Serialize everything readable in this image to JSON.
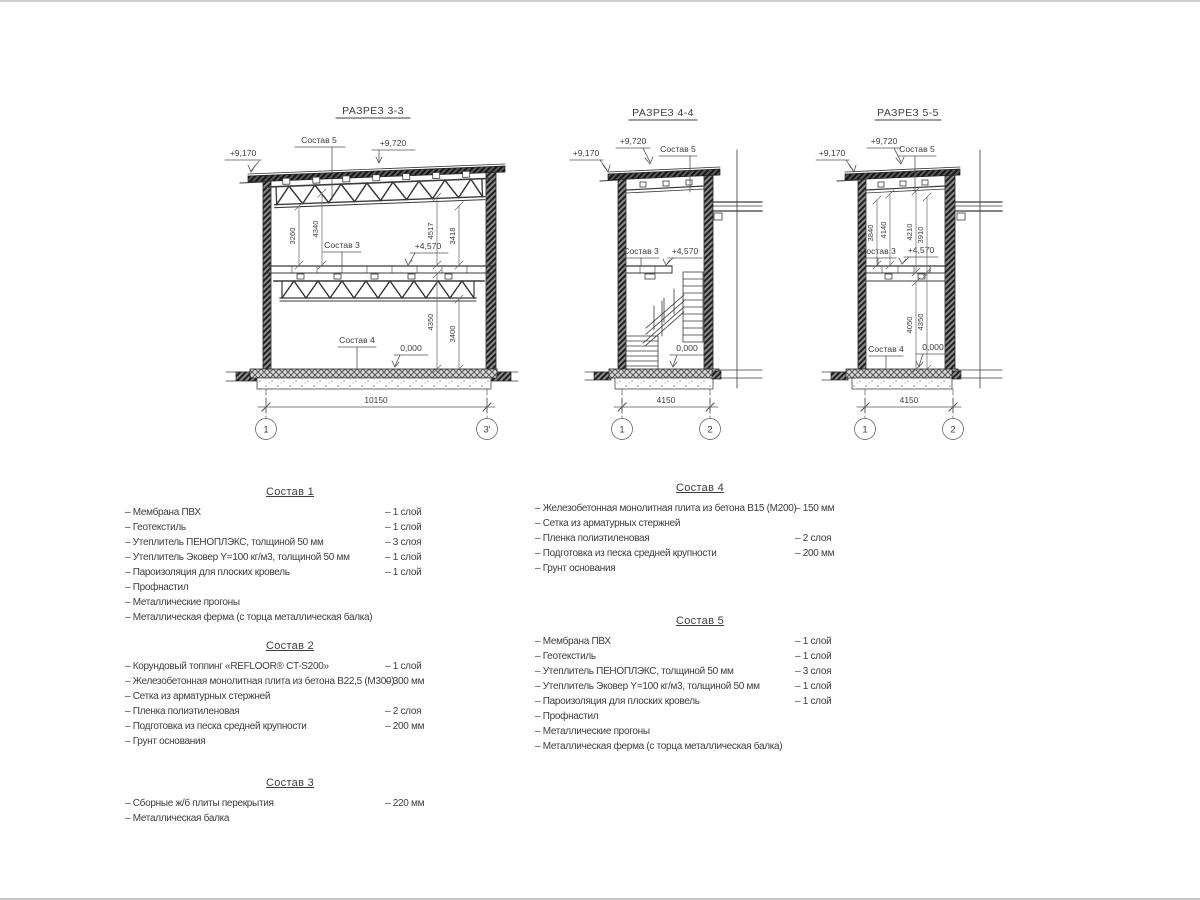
{
  "colors": {
    "line": "#3a3a3a",
    "wall_fill": "#4a4a4a",
    "dim_line": "#666666",
    "background": "#ffffff"
  },
  "sections": [
    {
      "title": "РАЗРЕЗ 3-3",
      "elev_eave": "+9,170",
      "elev_top": "+9,720",
      "elev_mid": "+4,570",
      "elev_zero": "0,000",
      "label_comp5": "Состав 5",
      "label_comp3": "Состав 3",
      "label_comp4": "Состав 4",
      "dim_u1": "3260",
      "dim_u2": "4340",
      "dim_u3": "4517",
      "dim_u4": "3418",
      "dim_l1": "4350",
      "dim_l2": "3400",
      "dim_width": "10150",
      "axis_left": "1",
      "axis_right": "3'"
    },
    {
      "title": "РАЗРЕЗ 4-4",
      "elev_eave": "+9,170",
      "elev_top": "+9,720",
      "elev_mid": "+4,570",
      "elev_zero": "0,000",
      "label_comp5": "Состав 5",
      "label_comp3": "Состав 3",
      "dim_width": "4150",
      "axis_left": "1",
      "axis_right": "2"
    },
    {
      "title": "РАЗРЕЗ 5-5",
      "elev_eave": "+9,170",
      "elev_top": "+9,720",
      "elev_mid": "+4,570",
      "elev_zero": "0,000",
      "label_comp5": "Состав 5",
      "label_comp3": "Состав 3",
      "label_comp4": "Состав 4",
      "dim_u1": "3840",
      "dim_u2": "4140",
      "dim_u3": "4210",
      "dim_u4": "3910",
      "dim_l1": "4050",
      "dim_l2": "4350",
      "dim_width": "4150",
      "axis_left": "1",
      "axis_right": "2"
    }
  ],
  "compositions": [
    {
      "title": "Состав 1",
      "items": [
        {
          "name": "– Мембрана ПВХ",
          "value": "– 1 слой"
        },
        {
          "name": "– Геотекстиль",
          "value": "– 1 слой"
        },
        {
          "name": "– Утеплитель ПЕНОПЛЭКС, толщиной 50 мм",
          "value": "– 3 слоя"
        },
        {
          "name": "– Утеплитель Эковер Y=100 кг/м3, толщиной 50 мм",
          "value": "– 1 слой"
        },
        {
          "name": "– Пароизоляция для плоских кровель",
          "value": "– 1 слой"
        },
        {
          "name": "– Профнастил",
          "value": ""
        },
        {
          "name": "– Металлические прогоны",
          "value": ""
        },
        {
          "name": "– Металлическая ферма (с торца металлическая балка)",
          "value": ""
        }
      ]
    },
    {
      "title": "Состав 2",
      "items": [
        {
          "name": "– Корундовый топпинг «REFLOOR® CT-S200»",
          "value": "– 1 слой"
        },
        {
          "name": "– Железобетонная  монолитная плита из бетона В22,5 (М300)",
          "value": "– 300 мм"
        },
        {
          "name": "– Сетка из арматурных стержней",
          "value": ""
        },
        {
          "name": "– Пленка полиэтиленовая",
          "value": "– 2 слоя"
        },
        {
          "name": "– Подготовка из песка средней крупности",
          "value": "– 200 мм"
        },
        {
          "name": "– Грунт основания",
          "value": ""
        }
      ]
    },
    {
      "title": "Состав 3",
      "items": [
        {
          "name": "– Сборные ж/б плиты перекрытия",
          "value": "– 220 мм"
        },
        {
          "name": "– Металлическая балка",
          "value": ""
        }
      ]
    },
    {
      "title": "Состав 4",
      "items": [
        {
          "name": "– Железобетонная  монолитная плита из бетона В15 (М200)",
          "value": "– 150 мм"
        },
        {
          "name": "– Сетка из арматурных стержней",
          "value": ""
        },
        {
          "name": "– Пленка полиэтиленовая",
          "value": "– 2 слоя"
        },
        {
          "name": "– Подготовка из песка средней крупности",
          "value": "– 200 мм"
        },
        {
          "name": "– Грунт основания",
          "value": ""
        }
      ]
    },
    {
      "title": "Состав 5",
      "items": [
        {
          "name": "– Мембрана ПВХ",
          "value": "– 1 слой"
        },
        {
          "name": "– Геотекстиль",
          "value": "– 1 слой"
        },
        {
          "name": "– Утеплитель ПЕНОПЛЭКС, толщиной 50 мм",
          "value": "– 3 слоя"
        },
        {
          "name": "– Утеплитель Эковер Y=100 кг/м3, толщиной 50 мм",
          "value": "– 1 слой"
        },
        {
          "name": "– Пароизоляция для плоских кровель",
          "value": "– 1 слой"
        },
        {
          "name": "– Профнастил",
          "value": ""
        },
        {
          "name": "– Металлические прогоны",
          "value": ""
        },
        {
          "name": "– Металлическая ферма (с торца металлическая балка)",
          "value": ""
        }
      ]
    }
  ]
}
